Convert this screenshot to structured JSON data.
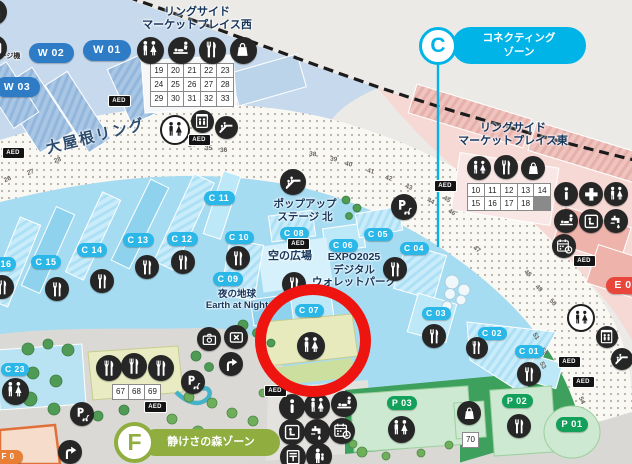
{
  "aed_text": "AED",
  "badges": {
    "connecting": {
      "letter": "C",
      "line1": "コネクティング",
      "line2": "ゾーン",
      "color": "#00b4e8"
    },
    "forest": {
      "letter": "F",
      "label": "静けさの森ゾーン",
      "color": "#8fae3f"
    }
  },
  "labels": [
    {
      "name": "west-marketplace-label",
      "text": "リングサイド\nマーケットプレイス西",
      "x": 197,
      "y": 6,
      "w": 170,
      "fs": 11,
      "color": "#16355b"
    },
    {
      "name": "east-marketplace-label",
      "text": "リングサイド\nマーケットプレイス東",
      "x": 513,
      "y": 122,
      "w": 175,
      "fs": 11,
      "color": "#16355b"
    },
    {
      "name": "grand-ring-label",
      "text": "大屋根リング",
      "x": 96,
      "y": 128,
      "w": 120,
      "fs": 15,
      "color": "#2d4d6e",
      "rot": -14,
      "ls": 2
    },
    {
      "name": "popup-stage-label",
      "text": "ポップアップ\nステージ 北",
      "x": 305,
      "y": 198,
      "w": 110,
      "fs": 10.5,
      "color": "#16355b"
    },
    {
      "name": "sky-plaza-label",
      "text": "空の広場",
      "x": 290,
      "y": 250,
      "w": 80,
      "fs": 11,
      "color": "#16355b"
    },
    {
      "name": "wallet-park-label",
      "text": "EXPO2025\nデジタル\nウォレットパーク",
      "x": 354,
      "y": 251,
      "w": 130,
      "fs": 10.5,
      "color": "#16355b"
    },
    {
      "name": "earth-at-night-label",
      "text": "夜の地球\nEarth at Night",
      "x": 237,
      "y": 289,
      "w": 110,
      "fs": 9.5,
      "color": "#16355b"
    },
    {
      "name": "charge-machine-label",
      "text": "ージ機",
      "x": 10,
      "y": 53,
      "w": 34,
      "fs": 7,
      "color": "#333333"
    }
  ],
  "pills": [
    {
      "t": "W 01",
      "k": "w",
      "x": 107,
      "y": 50,
      "w": 48,
      "h": 21,
      "fs": 11
    },
    {
      "t": "W 02",
      "k": "w",
      "x": 51,
      "y": 53,
      "w": 45,
      "h": 20,
      "fs": 10.5
    },
    {
      "t": "W 03",
      "k": "w",
      "x": 17,
      "y": 87,
      "w": 45,
      "h": 20,
      "fs": 10.5
    },
    {
      "t": "C 01",
      "k": "c",
      "x": 529,
      "y": 351,
      "w": 29,
      "h": 13,
      "fs": 8.5
    },
    {
      "t": "C 02",
      "k": "c",
      "x": 492,
      "y": 333,
      "w": 29,
      "h": 13,
      "fs": 8.5
    },
    {
      "t": "C 03",
      "k": "c",
      "x": 436,
      "y": 313,
      "w": 29,
      "h": 13,
      "fs": 8.5
    },
    {
      "t": "C 04",
      "k": "c",
      "x": 414,
      "y": 248,
      "w": 29,
      "h": 13,
      "fs": 8.5
    },
    {
      "t": "C 05",
      "k": "c",
      "x": 378,
      "y": 234,
      "w": 29,
      "h": 13,
      "fs": 8.5
    },
    {
      "t": "C 06",
      "k": "c",
      "x": 343,
      "y": 245,
      "w": 29,
      "h": 13,
      "fs": 8.5
    },
    {
      "t": "C 07",
      "k": "c",
      "x": 309,
      "y": 310,
      "w": 29,
      "h": 13,
      "fs": 8.5
    },
    {
      "t": "C 08",
      "k": "c",
      "x": 294,
      "y": 233,
      "w": 29,
      "h": 13,
      "fs": 8.5
    },
    {
      "t": "C 09",
      "k": "c",
      "x": 228,
      "y": 279,
      "w": 30,
      "h": 14,
      "fs": 9
    },
    {
      "t": "C 10",
      "k": "c",
      "x": 239,
      "y": 237,
      "w": 29,
      "h": 13,
      "fs": 8.5
    },
    {
      "t": "C 11",
      "k": "c",
      "x": 219,
      "y": 198,
      "w": 31,
      "h": 14,
      "fs": 9
    },
    {
      "t": "C 12",
      "k": "c",
      "x": 182,
      "y": 239,
      "w": 31,
      "h": 14,
      "fs": 9
    },
    {
      "t": "C 13",
      "k": "c",
      "x": 138,
      "y": 240,
      "w": 31,
      "h": 14,
      "fs": 9
    },
    {
      "t": "C 14",
      "k": "c",
      "x": 92,
      "y": 250,
      "w": 30,
      "h": 14,
      "fs": 9
    },
    {
      "t": "C 15",
      "k": "c",
      "x": 46,
      "y": 262,
      "w": 30,
      "h": 14,
      "fs": 9
    },
    {
      "t": "C 16",
      "k": "c",
      "x": 1,
      "y": 264,
      "w": 30,
      "h": 14,
      "fs": 9
    },
    {
      "t": "C 23",
      "k": "c",
      "x": 15,
      "y": 369,
      "w": 28,
      "h": 13,
      "fs": 8.5
    },
    {
      "t": "P 03",
      "k": "p",
      "x": 402,
      "y": 403,
      "w": 30,
      "h": 14,
      "fs": 9
    },
    {
      "t": "P 02",
      "k": "p",
      "x": 517,
      "y": 401,
      "w": 31,
      "h": 14,
      "fs": 9
    },
    {
      "t": "P 01",
      "k": "p",
      "x": 572,
      "y": 424,
      "w": 32,
      "h": 15,
      "fs": 9.5
    },
    {
      "t": "E 0",
      "k": "e",
      "x": 623,
      "y": 285,
      "w": 34,
      "h": 17,
      "fs": 10.5
    },
    {
      "t": "F 0",
      "k": "f",
      "x": 8,
      "y": 457,
      "w": 30,
      "h": 14,
      "fs": 8
    }
  ],
  "icons": [
    {
      "n": "restroom-icon",
      "g": "wc",
      "x": 150,
      "y": 50,
      "s": 27
    },
    {
      "n": "babycare-icon",
      "g": "baby",
      "x": 181,
      "y": 50,
      "s": 27
    },
    {
      "n": "restaurant-icon",
      "g": "fork",
      "x": 212,
      "y": 50,
      "s": 27
    },
    {
      "n": "shop-icon",
      "g": "bag",
      "x": 243,
      "y": 50,
      "s": 27
    },
    {
      "n": "gate-icon",
      "g": "arch",
      "x": -6,
      "y": 12,
      "s": 26
    },
    {
      "n": "charge-machine-icon",
      "g": "lock",
      "x": -6,
      "y": 48,
      "s": 26
    },
    {
      "n": "restroom-ring-icon",
      "g": "wc",
      "x": 175,
      "y": 130,
      "s": 30,
      "v": "light"
    },
    {
      "n": "elevator-icon",
      "g": "elev",
      "x": 202,
      "y": 121,
      "s": 23
    },
    {
      "n": "escalator-icon",
      "g": "esc",
      "x": 226,
      "y": 127,
      "s": 23
    },
    {
      "n": "escalator-icon",
      "g": "esc",
      "x": 293,
      "y": 182,
      "s": 26
    },
    {
      "n": "mobility-stop-icon",
      "g": "pscoot",
      "x": 404,
      "y": 207,
      "s": 26
    },
    {
      "n": "restaurant-icon",
      "g": "fork",
      "x": 238,
      "y": 258,
      "s": 24
    },
    {
      "n": "restaurant-icon",
      "g": "fork",
      "x": 183,
      "y": 262,
      "s": 24
    },
    {
      "n": "restaurant-icon",
      "g": "fork",
      "x": 147,
      "y": 267,
      "s": 24
    },
    {
      "n": "restaurant-icon",
      "g": "fork",
      "x": 102,
      "y": 281,
      "s": 24
    },
    {
      "n": "restaurant-icon",
      "g": "fork",
      "x": 57,
      "y": 289,
      "s": 24
    },
    {
      "n": "restaurant-icon",
      "g": "fork",
      "x": 2,
      "y": 287,
      "s": 24
    },
    {
      "n": "restaurant-icon",
      "g": "fork",
      "x": 294,
      "y": 284,
      "s": 24
    },
    {
      "n": "restaurant-icon",
      "g": "fork",
      "x": 395,
      "y": 269,
      "s": 24
    },
    {
      "n": "restaurant-icon",
      "g": "fork",
      "x": 434,
      "y": 336,
      "s": 24
    },
    {
      "n": "restaurant-icon",
      "g": "fork",
      "x": 477,
      "y": 348,
      "s": 22
    },
    {
      "n": "restaurant-icon",
      "g": "fork",
      "x": 529,
      "y": 374,
      "s": 24
    },
    {
      "n": "restaurant-icon",
      "g": "fork",
      "x": 519,
      "y": 426,
      "s": 24
    },
    {
      "n": "restaurant-icon",
      "g": "fork",
      "x": 109,
      "y": 368,
      "s": 26
    },
    {
      "n": "restaurant-icon",
      "g": "fork",
      "x": 134,
      "y": 366,
      "s": 26
    },
    {
      "n": "restaurant-icon",
      "g": "fork",
      "x": 161,
      "y": 368,
      "s": 26
    },
    {
      "n": "restroom-icon",
      "g": "wc",
      "x": 15,
      "y": 391,
      "s": 27
    },
    {
      "n": "photo-spot-icon",
      "g": "cam",
      "x": 209,
      "y": 339,
      "s": 24
    },
    {
      "n": "locker-icon",
      "g": "lock",
      "x": 236,
      "y": 337,
      "s": 24
    },
    {
      "n": "slope-arrow-icon",
      "g": "arrow",
      "x": 231,
      "y": 364,
      "s": 24
    },
    {
      "n": "slope-arrow-icon",
      "g": "arrow",
      "x": 70,
      "y": 452,
      "s": 24
    },
    {
      "n": "mobility-stop-icon",
      "g": "pscoot",
      "x": 193,
      "y": 382,
      "s": 24
    },
    {
      "n": "mobility-stop-icon",
      "g": "pscoot",
      "x": 82,
      "y": 414,
      "s": 24
    },
    {
      "n": "restroom-highlighted-icon",
      "g": "wc",
      "x": 311,
      "y": 346,
      "s": 28
    },
    {
      "n": "info-icon",
      "g": "info",
      "x": 292,
      "y": 407,
      "s": 26
    },
    {
      "n": "restroom-icon",
      "g": "wc",
      "x": 317,
      "y": 406,
      "s": 26
    },
    {
      "n": "babycare-icon",
      "g": "baby",
      "x": 344,
      "y": 404,
      "s": 26
    },
    {
      "n": "rest-space-icon",
      "g": "seat",
      "x": 292,
      "y": 432,
      "s": 26
    },
    {
      "n": "water-station-icon",
      "g": "tap",
      "x": 317,
      "y": 432,
      "s": 26
    },
    {
      "n": "reservation-spot-icon",
      "g": "cal",
      "x": 342,
      "y": 431,
      "s": 26
    },
    {
      "n": "post-office-icon",
      "g": "post",
      "x": 293,
      "y": 457,
      "s": 26
    },
    {
      "n": "lost-child-icon",
      "g": "person",
      "x": 319,
      "y": 456,
      "s": 26
    },
    {
      "n": "restroom-icon",
      "g": "wc",
      "x": 401,
      "y": 429,
      "s": 27
    },
    {
      "n": "shop-icon",
      "g": "bag",
      "x": 469,
      "y": 413,
      "s": 24
    },
    {
      "n": "restroom-icon",
      "g": "wc",
      "x": 479,
      "y": 168,
      "s": 24
    },
    {
      "n": "restaurant-icon",
      "g": "fork",
      "x": 506,
      "y": 167,
      "s": 24
    },
    {
      "n": "shop-icon",
      "g": "bag",
      "x": 533,
      "y": 168,
      "s": 24
    },
    {
      "n": "info-icon",
      "g": "info",
      "x": 566,
      "y": 194,
      "s": 24
    },
    {
      "n": "first-aid-icon",
      "g": "cross",
      "x": 591,
      "y": 194,
      "s": 24
    },
    {
      "n": "restroom-icon",
      "g": "wc",
      "x": 616,
      "y": 194,
      "s": 24
    },
    {
      "n": "babycare-icon",
      "g": "baby",
      "x": 566,
      "y": 221,
      "s": 24
    },
    {
      "n": "rest-space-icon",
      "g": "seat",
      "x": 591,
      "y": 221,
      "s": 24
    },
    {
      "n": "water-station-icon",
      "g": "tap",
      "x": 616,
      "y": 221,
      "s": 24
    },
    {
      "n": "reservation-spot-icon",
      "g": "cal",
      "x": 564,
      "y": 246,
      "s": 24
    },
    {
      "n": "restroom-ring-icon",
      "g": "wc",
      "x": 581,
      "y": 318,
      "s": 28,
      "v": "light"
    },
    {
      "n": "elevator-icon",
      "g": "elev",
      "x": 607,
      "y": 337,
      "s": 22
    },
    {
      "n": "escalator-icon",
      "g": "esc",
      "x": 622,
      "y": 359,
      "s": 22
    }
  ],
  "aed_badges": [
    {
      "x": 118,
      "y": 100
    },
    {
      "x": 12,
      "y": 152
    },
    {
      "x": 198,
      "y": 139
    },
    {
      "x": 297,
      "y": 243
    },
    {
      "x": 444,
      "y": 185
    },
    {
      "x": 583,
      "y": 260
    },
    {
      "x": 568,
      "y": 361
    },
    {
      "x": 582,
      "y": 381
    },
    {
      "x": 154,
      "y": 406
    },
    {
      "x": 274,
      "y": 390
    }
  ],
  "grids": [
    {
      "name": "west-stall-numbers",
      "x": 150,
      "y": 63,
      "cw": 15.6,
      "ch": 13.2,
      "rows": [
        [
          "19",
          "20",
          "21",
          "22",
          "23"
        ],
        [
          "24",
          "25",
          "26",
          "27",
          "28"
        ],
        [
          "29",
          "30",
          "31",
          "32",
          "33"
        ]
      ]
    },
    {
      "name": "east-stall-numbers",
      "x": 467,
      "y": 183,
      "cw": 15.6,
      "ch": 12.4,
      "rows": [
        [
          "10",
          "11",
          "12",
          "13",
          "14"
        ],
        [
          "15",
          "16",
          "17",
          "18"
        ]
      ]
    },
    {
      "name": "forest-stall-numbers",
      "x": 112,
      "y": 384,
      "cw": 15,
      "ch": 13.5,
      "rows": [
        [
          "67",
          "68",
          "69"
        ]
      ]
    },
    {
      "name": "p-zone-stall-numbers",
      "x": 462,
      "y": 432,
      "cw": 15,
      "ch": 13.5,
      "rows": [
        [
          "70"
        ]
      ]
    }
  ],
  "ring_numbers": [
    {
      "t": "26",
      "x": 4,
      "y": 176,
      "r": -24
    },
    {
      "t": "27",
      "x": 27,
      "y": 169,
      "r": -22
    },
    {
      "t": "28",
      "x": 54,
      "y": 157,
      "r": -20
    },
    {
      "t": "34",
      "x": 188,
      "y": 142,
      "r": -6
    },
    {
      "t": "35",
      "x": 205,
      "y": 145,
      "r": -4
    },
    {
      "t": "36",
      "x": 220,
      "y": 147,
      "r": -3
    },
    {
      "t": "38",
      "x": 309,
      "y": 151,
      "r": 6
    },
    {
      "t": "39",
      "x": 330,
      "y": 156,
      "r": 8
    },
    {
      "t": "40",
      "x": 345,
      "y": 161,
      "r": 10
    },
    {
      "t": "41",
      "x": 367,
      "y": 168,
      "r": 13
    },
    {
      "t": "42",
      "x": 385,
      "y": 175,
      "r": 16
    },
    {
      "t": "43",
      "x": 405,
      "y": 184,
      "r": 20
    },
    {
      "t": "44",
      "x": 427,
      "y": 198,
      "r": 24
    },
    {
      "t": "45",
      "x": 443,
      "y": 196,
      "r": 28
    },
    {
      "t": "46",
      "x": 448,
      "y": 209,
      "r": 32
    },
    {
      "t": "47",
      "x": 473,
      "y": 246,
      "r": 36
    },
    {
      "t": "48",
      "x": 524,
      "y": 270,
      "r": 40
    },
    {
      "t": "49",
      "x": 535,
      "y": 285,
      "r": 44
    },
    {
      "t": "50",
      "x": 549,
      "y": 299,
      "r": 48
    },
    {
      "t": "51",
      "x": 532,
      "y": 333,
      "r": 58
    },
    {
      "t": "52",
      "x": 540,
      "y": 348,
      "r": 61
    },
    {
      "t": "53",
      "x": 539,
      "y": 362,
      "r": 63
    },
    {
      "t": "54",
      "x": 578,
      "y": 397,
      "r": 66
    }
  ],
  "annotation": {
    "x": 255,
    "y": 284,
    "w": 116,
    "h": 113,
    "stroke": "#ee1410",
    "sw": 11
  }
}
